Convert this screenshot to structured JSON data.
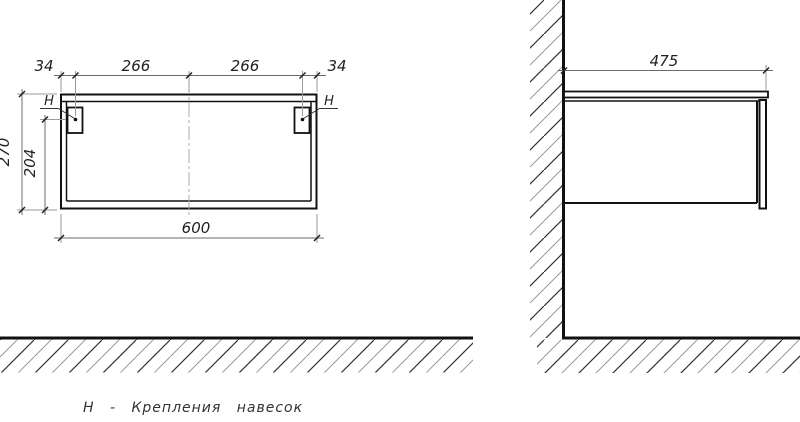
{
  "front": {
    "dim_offset_left": "34",
    "dim_span_left": "266",
    "dim_span_right": "266",
    "dim_offset_right": "34",
    "dim_height": "270",
    "dim_hanger_height": "204",
    "dim_width": "600",
    "hanger_label_left": "Н",
    "hanger_label_right": "Н"
  },
  "side": {
    "dim_depth": "475"
  },
  "note": {
    "legend": "Н - Крепления навесок"
  },
  "colors": {
    "outline": "#111111",
    "dimension_line": "#6b6b6b",
    "extension_line": "#9a9a9a",
    "centerline": "#aaaaaa",
    "hatch_dark": "#333333",
    "hatch_light": "#999999",
    "text": "#222222",
    "background": "#ffffff"
  }
}
